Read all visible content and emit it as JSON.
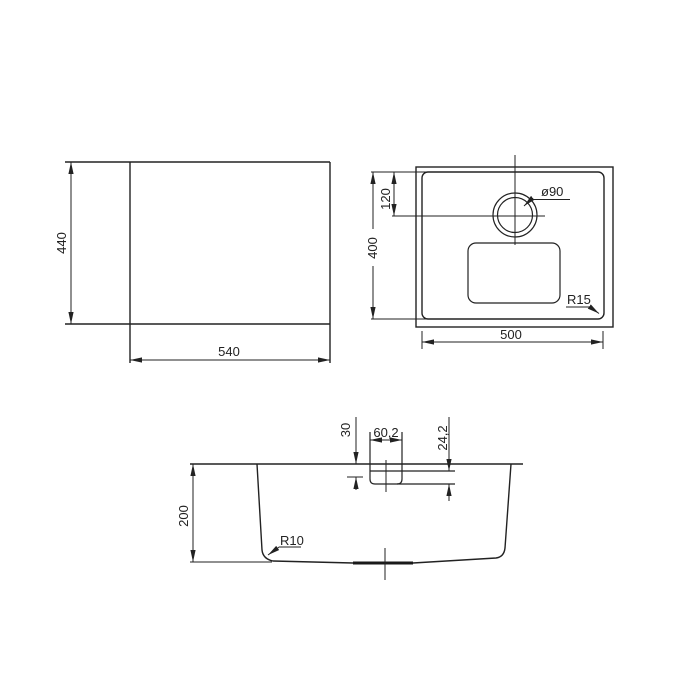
{
  "background": "#ffffff",
  "line_color": "#222222",
  "drawing_type": "sink dimension drawing",
  "views": {
    "overall": {
      "width": "540",
      "height": "440"
    },
    "bowl": {
      "width": "500",
      "depth": "400",
      "drain_offset": "120",
      "drain_diameter": "ø90",
      "corner_radius": "R15"
    },
    "section": {
      "depth": "200",
      "bottom_radius": "R10",
      "recess_width": "60,2",
      "recess_offset": "30",
      "recess_depth": "24,2"
    }
  }
}
